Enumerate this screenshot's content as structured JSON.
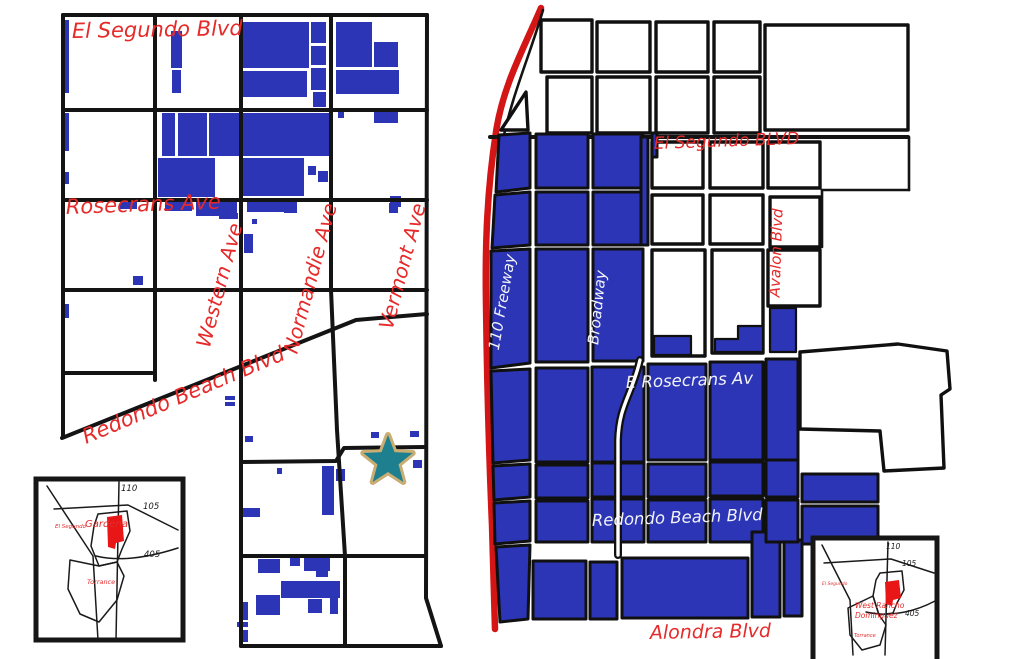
{
  "colors": {
    "parcel_blue": "#2B35B5",
    "label_red": "#E62A2A",
    "freeway_red": "#D31515",
    "street_black": "#141414",
    "star_teal": "#1E7F8E",
    "star_gold": "#C9AD72",
    "background": "#FFFFFF"
  },
  "left_map": {
    "streets": {
      "el_segundo": "El Segundo Blvd",
      "rosecrans": "Rosecrans Ave",
      "western": "Western Ave",
      "normandie": "Normandie Ave",
      "vermont": "Vermont Ave",
      "redondo_beach": "Redondo Beach Blvd"
    },
    "inset": {
      "city": "Gardena",
      "neighbor_west": "El Segundo",
      "neighbor_south": "Torrance",
      "fwy_110": "110",
      "fwy_105": "105",
      "fwy_405": "405"
    }
  },
  "right_map": {
    "streets": {
      "el_segundo": "El Segundo BLVD",
      "freeway_110": "110 Freeway",
      "broadway": "Broadway",
      "avalon": "Avalon Blvd",
      "rosecrans": "E Rosecrans Av",
      "redondo_beach": "Redondo Beach Blvd",
      "alondra": "Alondra Blvd"
    },
    "inset": {
      "city_line1": "West Rancho",
      "city_line2": "Dominguez",
      "neighbor_west": "El Segundo",
      "neighbor_south": "Torrance",
      "fwy_110": "110",
      "fwy_105": "105",
      "fwy_405": "405"
    }
  }
}
